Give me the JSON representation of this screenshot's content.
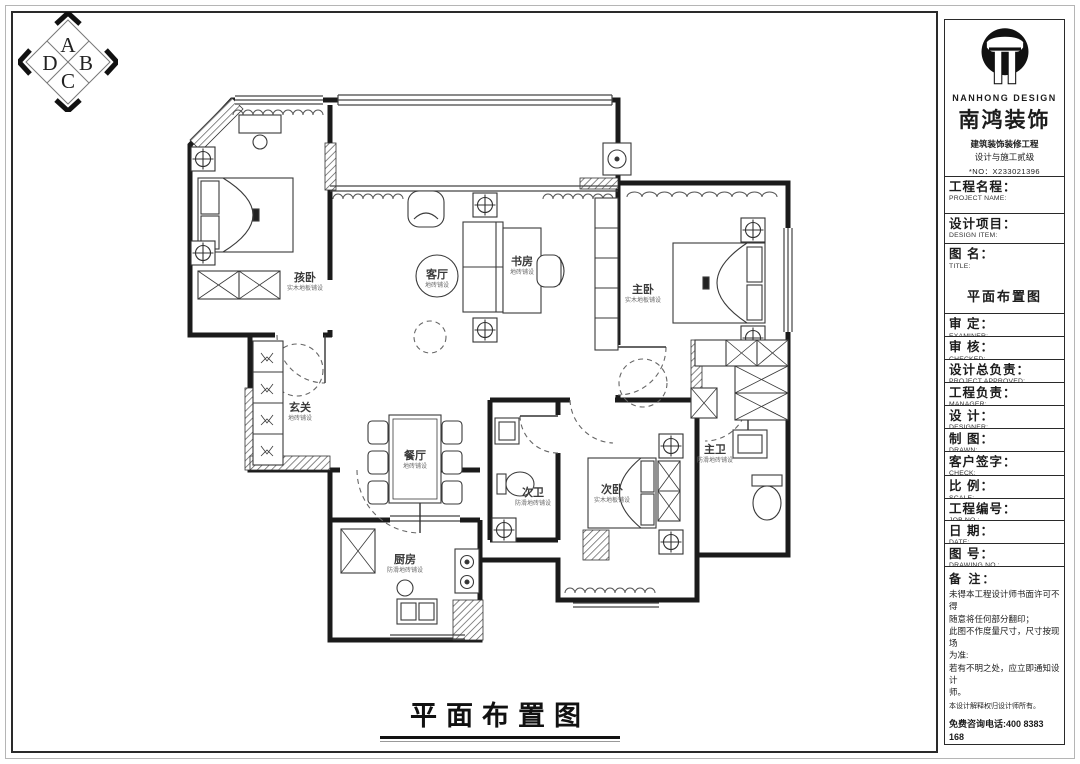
{
  "compass": {
    "top": "A",
    "right": "B",
    "bottom": "C",
    "left": "D"
  },
  "plan": {
    "title": "平面布置图",
    "rooms": [
      {
        "name": "孩卧",
        "finish": "实木地板铺设"
      },
      {
        "name": "客厅",
        "finish": "地砖铺设"
      },
      {
        "name": "书房",
        "finish": "地砖铺设"
      },
      {
        "name": "主卧",
        "finish": "实木地板铺设"
      },
      {
        "name": "玄关",
        "finish": "地砖铺设"
      },
      {
        "name": "餐厅",
        "finish": "地砖铺设"
      },
      {
        "name": "次卫",
        "finish": "防滑地砖铺设"
      },
      {
        "name": "次卧",
        "finish": "实木地板铺设"
      },
      {
        "name": "主卫",
        "finish": "防滑地砖铺设"
      },
      {
        "name": "厨房",
        "finish": "防滑地砖铺设"
      }
    ]
  },
  "titleblock": {
    "brand": {
      "en": "NANHONG DESIGN",
      "cn": "南鸿装饰",
      "line1": "建筑装饰装修工程",
      "line2": "设计与施工贰级",
      "no": "*NO：X233021396"
    },
    "fields": [
      {
        "cn": "工程名程：",
        "en": "PROJECT NAME:",
        "value": ""
      },
      {
        "cn": "设计项目：",
        "en": "DESIGN ITEM:",
        "value": ""
      },
      {
        "cn": "图  名：",
        "en": "TITLE:",
        "value": "平面布置图"
      },
      {
        "cn": "审  定：",
        "en": "EXAMINER:",
        "value": ""
      },
      {
        "cn": "审  核：",
        "en": "CHECKED:",
        "value": ""
      },
      {
        "cn": "设计总负责：",
        "en": "PROJECT APPROVED:",
        "value": ""
      },
      {
        "cn": "工程负责：",
        "en": "MANAGER:",
        "value": ""
      },
      {
        "cn": "设  计：",
        "en": "DESIGNER:",
        "value": ""
      },
      {
        "cn": "制  图：",
        "en": "DRAWN:",
        "value": ""
      },
      {
        "cn": "客户签字：",
        "en": "CHECK:",
        "value": ""
      },
      {
        "cn": "比  例：",
        "en": "SCALE:",
        "value": ""
      },
      {
        "cn": "工程编号：",
        "en": "JOB NO.:",
        "value": ""
      },
      {
        "cn": "日  期：",
        "en": "DATE:",
        "value": ""
      },
      {
        "cn": "图  号：",
        "en": "DRAWING NO.:",
        "value": ""
      }
    ],
    "notes": {
      "label": "备 注：",
      "lines": [
        "未得本工程设计师书面许可不得",
        "随意将任何部分翻印；",
        "此图不作度量尺寸，尺寸按现场",
        "为准:",
        "若有不明之处，应立即通知设计",
        "师。"
      ],
      "small": "本设计解释权归设计师所有。",
      "phone": "免费咨询电话:400 8383 168"
    }
  }
}
